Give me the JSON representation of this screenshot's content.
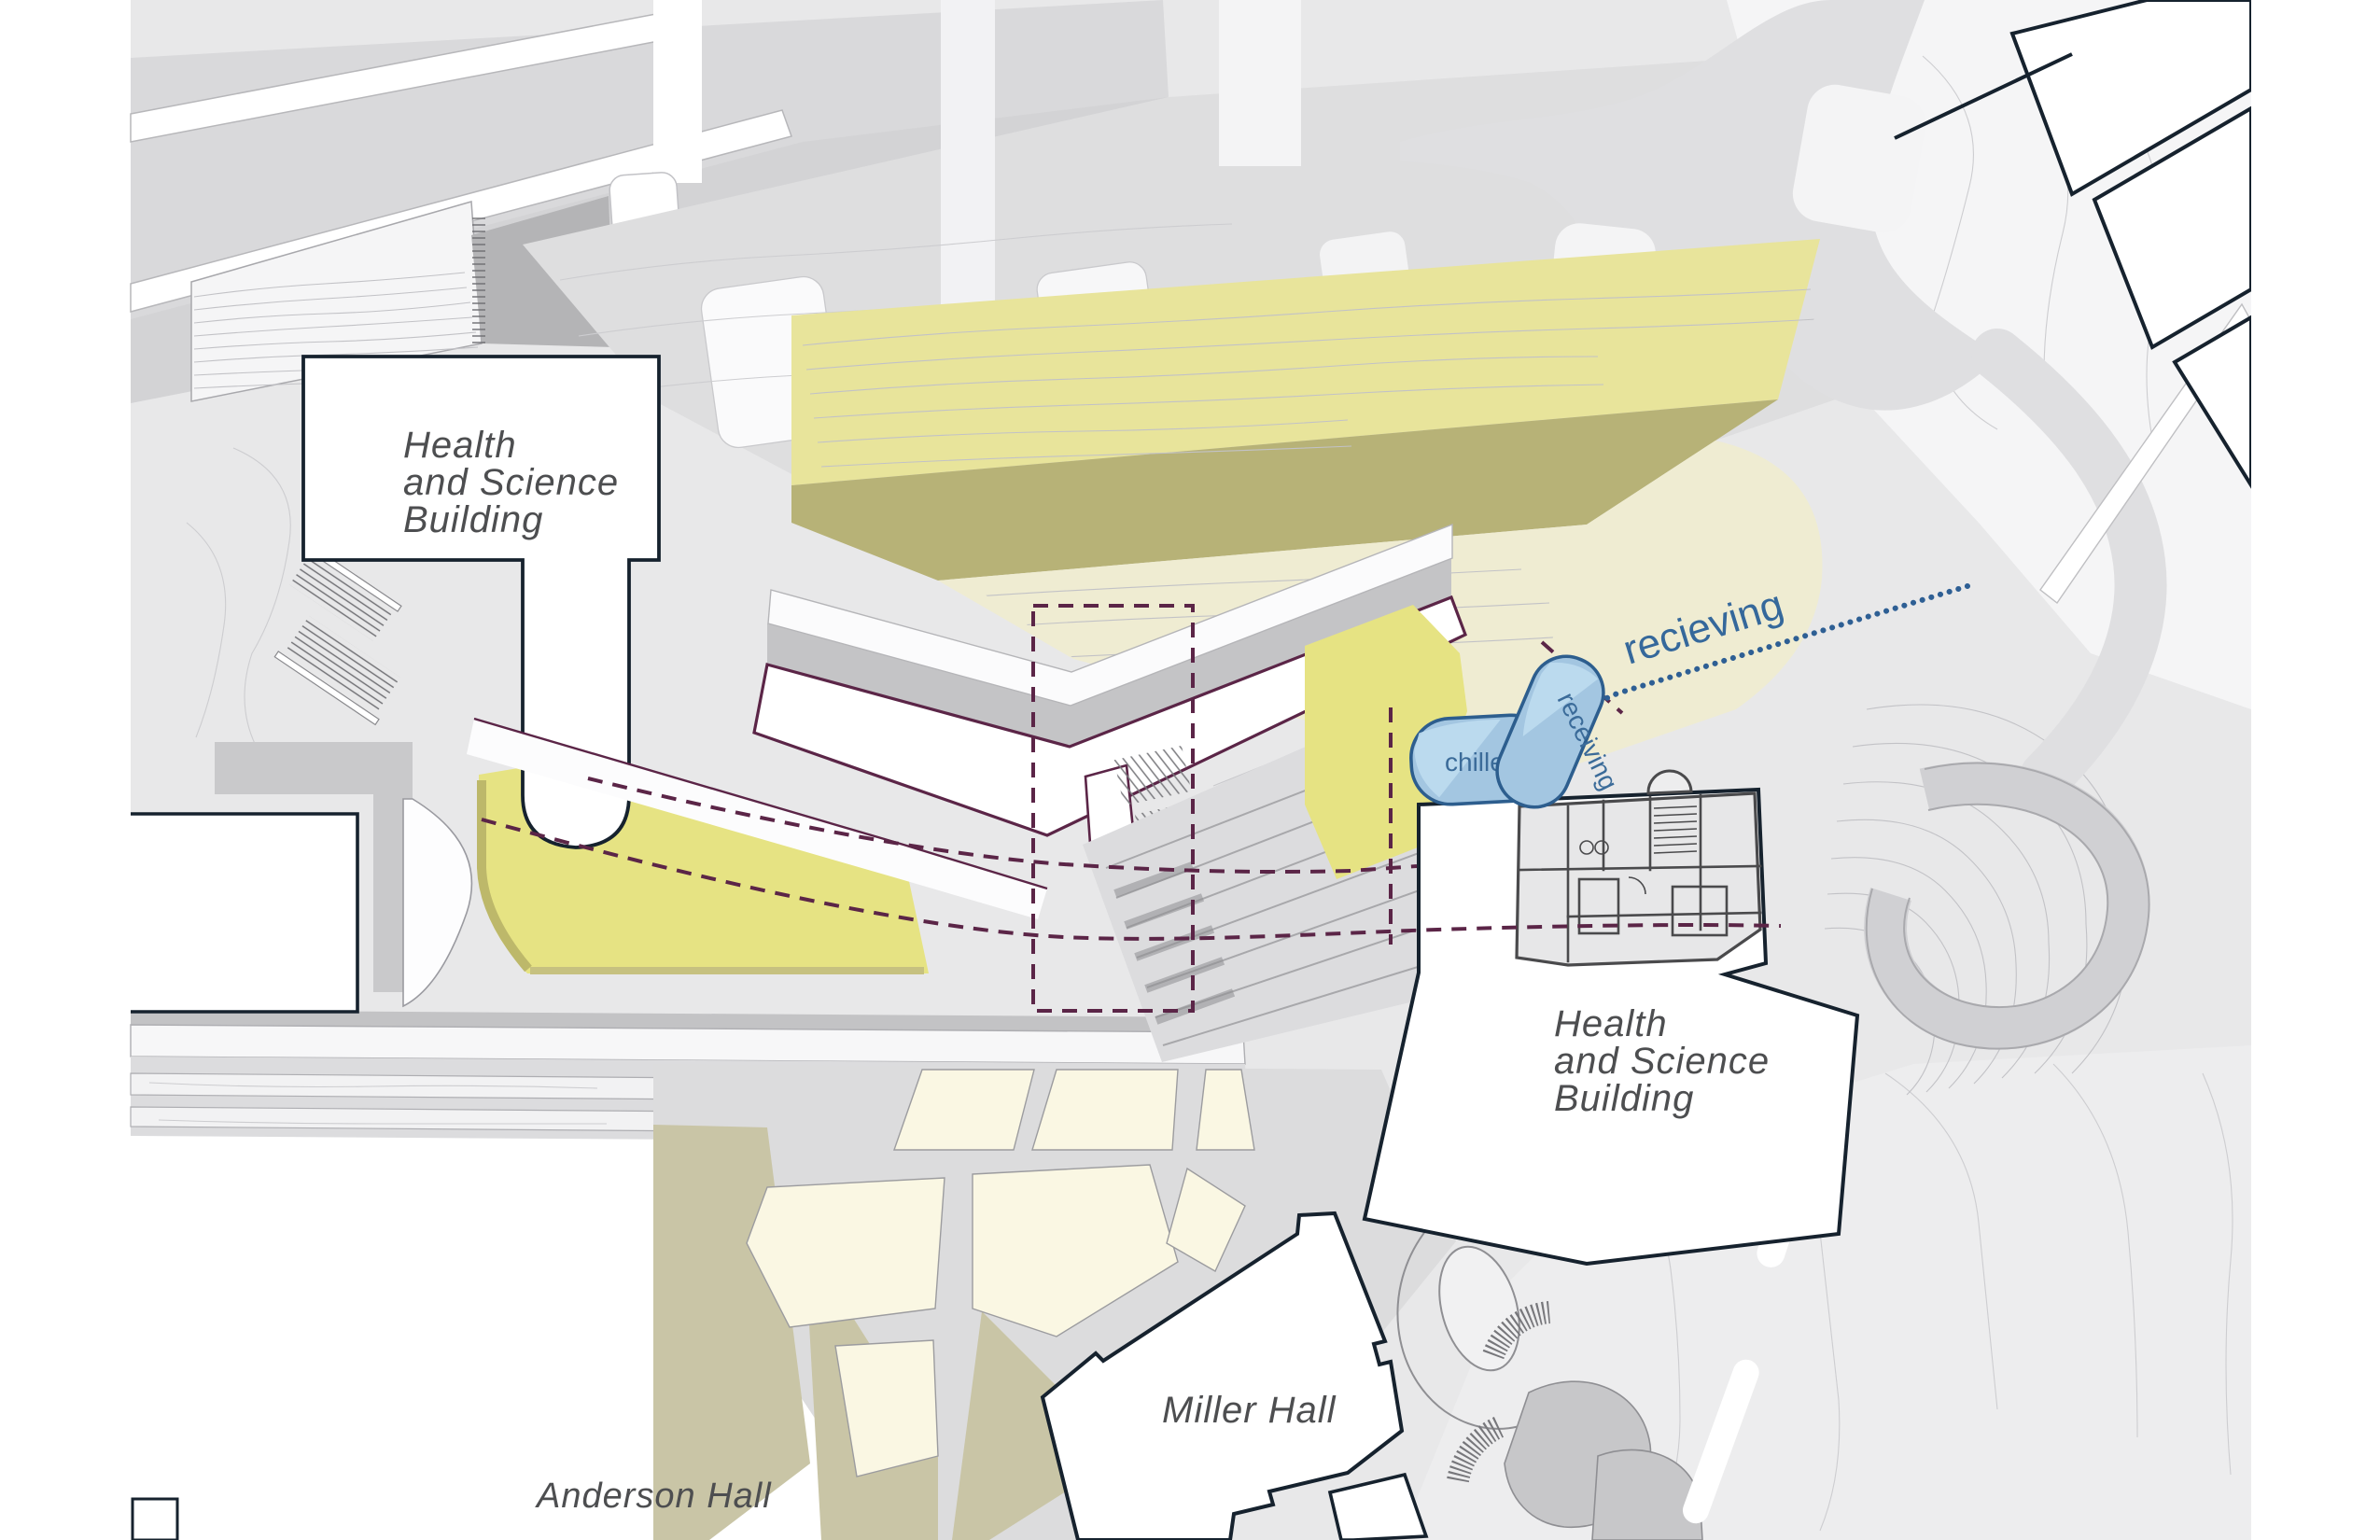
{
  "plan": {
    "labels": {
      "building_top_left": {
        "line1": "Health",
        "line2": "and Science",
        "line3": "Building"
      },
      "building_right": {
        "line1": "Health",
        "line2": "and Science",
        "line3": "Building"
      },
      "miller_hall": "Miller Hall",
      "anderson_hall": "Anderson Hall"
    },
    "zones": {
      "chiller": "chiller",
      "receiving_zone": "receiving",
      "receiving_route": "recieving"
    },
    "colors": {
      "highlight_yellow": "#e6e383",
      "highlight_yellow_band": "#e8e49b",
      "highlight_yellow_pale": "#efecd2",
      "highlight_olive": "#b7b277",
      "garden_cream": "#faf7e3",
      "garden_olive": "#c9c5a6",
      "zone_blue_fill": "#a3c6e1",
      "zone_blue_fill_light": "#bedbf0",
      "zone_blue_stroke": "#2d5e8e",
      "blue_text": "#35689b",
      "route_dot_blue": "#2e5f94",
      "plan_maroon": "#5b2547",
      "building_outline": "#16222e",
      "label_gray": "#4d4e50"
    }
  }
}
